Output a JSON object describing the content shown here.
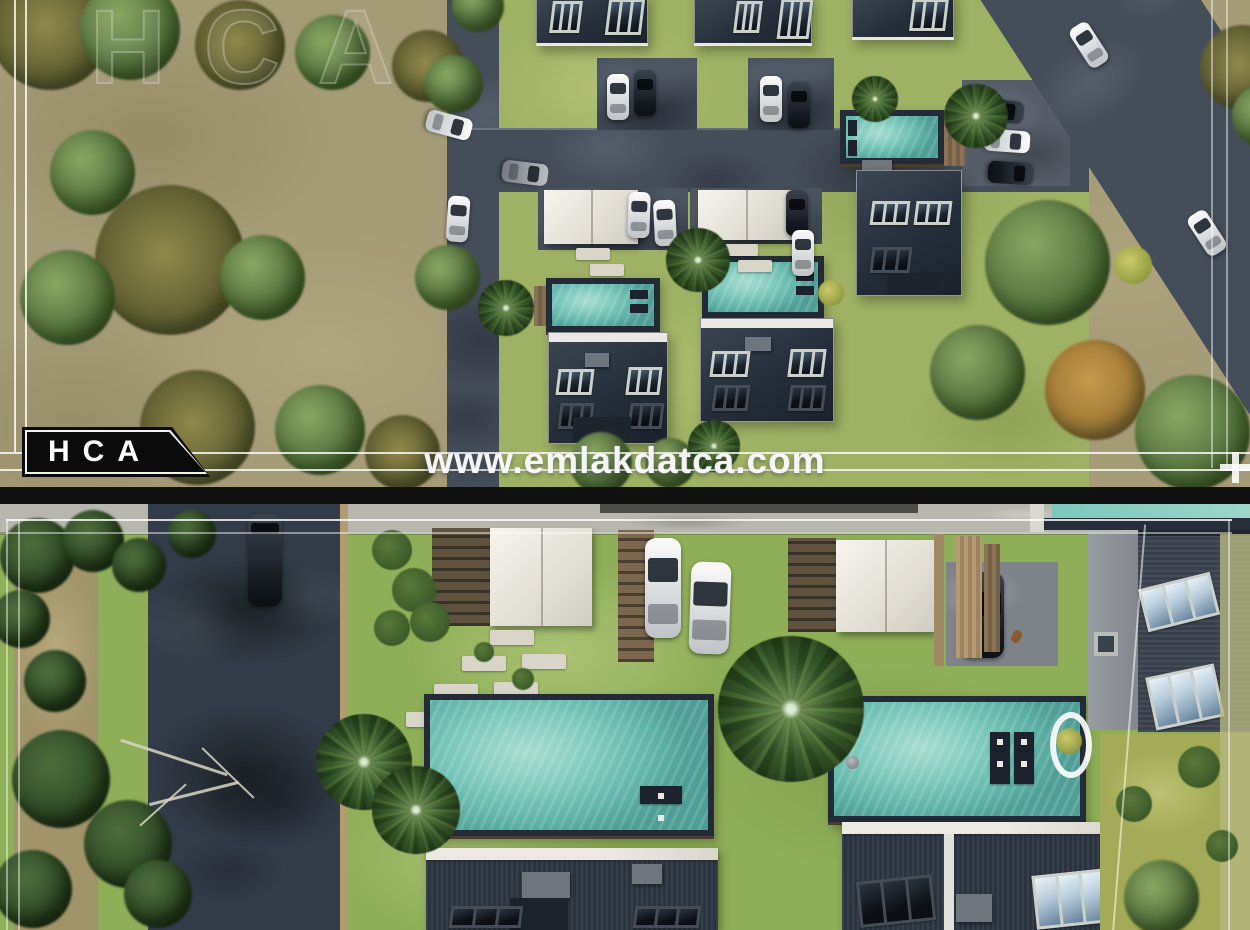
{
  "image": {
    "kind": "real-estate aerial 3D render shown as two stacked views",
    "width_px": 1250,
    "height_px": 930
  },
  "overlays": {
    "brand_badge": "HCA",
    "ghost_brand_watermark": "HCA",
    "site_watermark": "www.emlakdatca.com"
  },
  "palette": {
    "field_olive": "#a49b77",
    "grass_green": "#9fb164",
    "grass_bright": "#8fae58",
    "road_dark": "#454d59",
    "road_shadowed": "#333b48",
    "roof_dark": "#252e3a",
    "roof_ridge_white": "#e9e8e2",
    "pool_teal": "#7cc8bb",
    "canopy_white": "#f0ede6",
    "wood_brown": "#8a7254",
    "concrete_light": "#b7b7af",
    "frame_line_white": "#ffffff",
    "badge_black": "#0b0b0b",
    "badge_text_white": "#ffffff",
    "separator_grey": "#e6e6e0"
  },
  "scenes": [
    {
      "id": "top",
      "description": "site overview: villa complex with rooftop solar panels, private pools, internal road, parked cars, green field with trees, diagonal access road"
    },
    {
      "id": "bottom",
      "description": "close-up: pergola carports, stepping-stone garden paths, two large pools with sun loungers, palm trees, modern villa roofs"
    }
  ]
}
